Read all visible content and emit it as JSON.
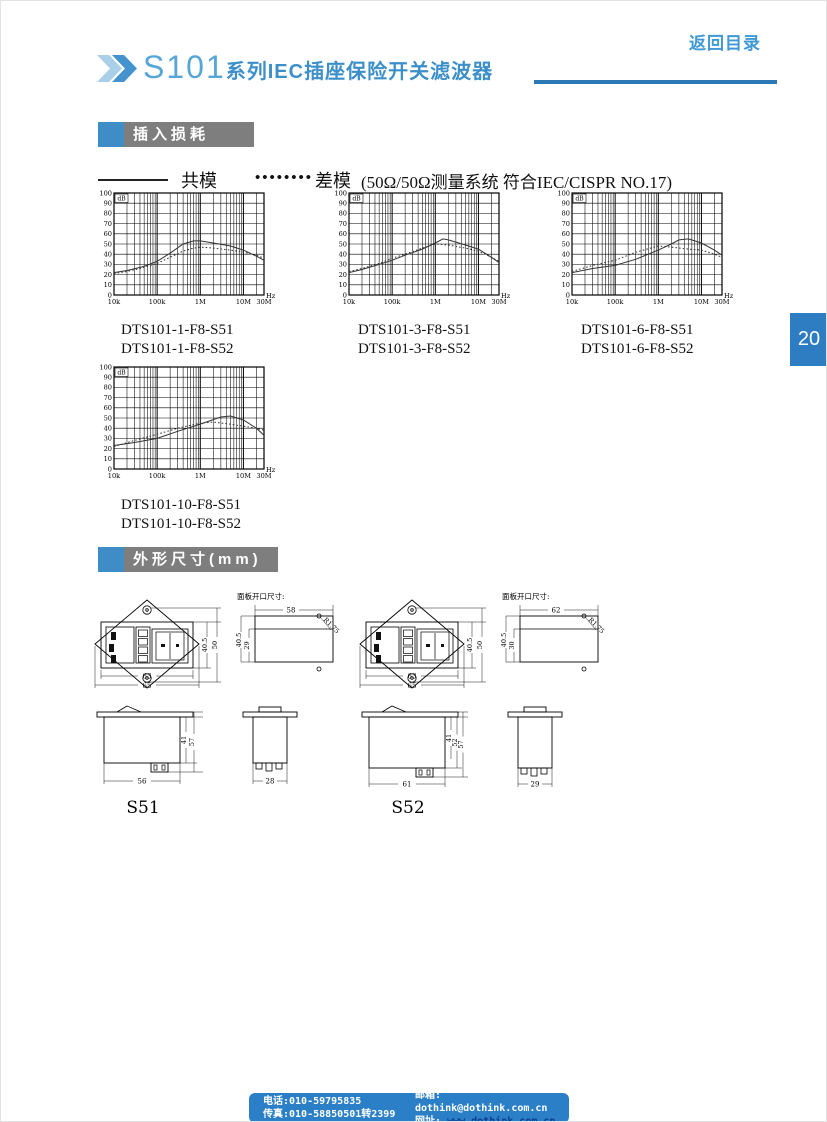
{
  "page": {
    "number": "20"
  },
  "nav": {
    "back_link": "返回目录"
  },
  "header": {
    "series": "S101",
    "title_rest": "系列IEC插座保险开关滤波器"
  },
  "sections": {
    "insertion_loss": "插入损耗",
    "dimensions": "外形尺寸(mm)"
  },
  "legend": {
    "solid_label": "共模",
    "dots": "••••••••",
    "dotted_label": "差模",
    "note": "(50Ω/50Ω测量系统 符合IEC/CISPR NO.17)"
  },
  "chart_data": [
    {
      "type": "line",
      "caption_lines": [
        "DTS101-1-F8-S51",
        "DTS101-1-F8-S52"
      ],
      "xlabel_unit": "Hz",
      "ylabel_unit": "dB",
      "ylim": [
        0,
        100
      ],
      "y_step": 10,
      "x_log_range_hz": [
        10000,
        30000000
      ],
      "x_ticks": [
        {
          "hz": 10000,
          "label": "10k"
        },
        {
          "hz": 100000,
          "label": "100k"
        },
        {
          "hz": 1000000,
          "label": "1M"
        },
        {
          "hz": 10000000,
          "label": "10M"
        },
        {
          "hz": 30000000,
          "label": "30M"
        }
      ],
      "series": [
        {
          "name": "共模",
          "style": "solid",
          "points": [
            [
              10000,
              22
            ],
            [
              20000,
              24
            ],
            [
              50000,
              28
            ],
            [
              100000,
              33
            ],
            [
              200000,
              41
            ],
            [
              400000,
              50
            ],
            [
              700000,
              53
            ],
            [
              1000000,
              53
            ],
            [
              2000000,
              51
            ],
            [
              5000000,
              48
            ],
            [
              10000000,
              44
            ],
            [
              20000000,
              38
            ],
            [
              30000000,
              34
            ]
          ]
        },
        {
          "name": "差模",
          "style": "dotted",
          "points": [
            [
              10000,
              21
            ],
            [
              20000,
              23
            ],
            [
              50000,
              27
            ],
            [
              100000,
              31
            ],
            [
              200000,
              37
            ],
            [
              400000,
              43
            ],
            [
              700000,
              46
            ],
            [
              1000000,
              47
            ],
            [
              2000000,
              46
            ],
            [
              5000000,
              44
            ],
            [
              10000000,
              42
            ],
            [
              20000000,
              39
            ],
            [
              30000000,
              36
            ]
          ]
        }
      ]
    },
    {
      "type": "line",
      "caption_lines": [
        "DTS101-3-F8-S51",
        "DTS101-3-F8-S52"
      ],
      "xlabel_unit": "Hz",
      "ylabel_unit": "dB",
      "ylim": [
        0,
        100
      ],
      "y_step": 10,
      "x_log_range_hz": [
        10000,
        30000000
      ],
      "x_ticks": [
        {
          "hz": 10000,
          "label": "10k"
        },
        {
          "hz": 100000,
          "label": "100k"
        },
        {
          "hz": 1000000,
          "label": "1M"
        },
        {
          "hz": 10000000,
          "label": "10M"
        },
        {
          "hz": 30000000,
          "label": "30M"
        }
      ],
      "series": [
        {
          "name": "共模",
          "style": "solid",
          "points": [
            [
              10000,
              22
            ],
            [
              20000,
              25
            ],
            [
              50000,
              30
            ],
            [
              100000,
              34
            ],
            [
              200000,
              39
            ],
            [
              500000,
              45
            ],
            [
              1000000,
              51
            ],
            [
              1500000,
              55
            ],
            [
              2000000,
              54
            ],
            [
              5000000,
              49
            ],
            [
              10000000,
              45
            ],
            [
              20000000,
              37
            ],
            [
              30000000,
              32
            ]
          ]
        },
        {
          "name": "差模",
          "style": "dotted",
          "points": [
            [
              10000,
              23
            ],
            [
              20000,
              26
            ],
            [
              50000,
              31
            ],
            [
              100000,
              36
            ],
            [
              200000,
              40
            ],
            [
              500000,
              46
            ],
            [
              1000000,
              50
            ],
            [
              2000000,
              49
            ],
            [
              5000000,
              46
            ],
            [
              10000000,
              43
            ],
            [
              20000000,
              37
            ],
            [
              30000000,
              33
            ]
          ]
        }
      ]
    },
    {
      "type": "line",
      "caption_lines": [
        "DTS101-6-F8-S51",
        "DTS101-6-F8-S52"
      ],
      "xlabel_unit": "Hz",
      "ylabel_unit": "dB",
      "ylim": [
        0,
        100
      ],
      "y_step": 10,
      "x_log_range_hz": [
        10000,
        30000000
      ],
      "x_ticks": [
        {
          "hz": 10000,
          "label": "10k"
        },
        {
          "hz": 100000,
          "label": "100k"
        },
        {
          "hz": 1000000,
          "label": "1M"
        },
        {
          "hz": 10000000,
          "label": "10M"
        },
        {
          "hz": 30000000,
          "label": "30M"
        }
      ],
      "series": [
        {
          "name": "共模",
          "style": "solid",
          "points": [
            [
              10000,
              22
            ],
            [
              30000,
              26
            ],
            [
              100000,
              29
            ],
            [
              300000,
              35
            ],
            [
              1000000,
              44
            ],
            [
              2000000,
              50
            ],
            [
              3000000,
              54
            ],
            [
              5000000,
              55
            ],
            [
              10000000,
              51
            ],
            [
              20000000,
              44
            ],
            [
              30000000,
              39
            ]
          ]
        },
        {
          "name": "差模",
          "style": "dotted",
          "points": [
            [
              10000,
              23
            ],
            [
              30000,
              29
            ],
            [
              100000,
              34
            ],
            [
              300000,
              42
            ],
            [
              1000000,
              48
            ],
            [
              2000000,
              47
            ],
            [
              5000000,
              45
            ],
            [
              10000000,
              44
            ],
            [
              20000000,
              40
            ],
            [
              30000000,
              37
            ]
          ]
        }
      ]
    },
    {
      "type": "line",
      "caption_lines": [
        "DTS101-10-F8-S51",
        "DTS101-10-F8-S52"
      ],
      "xlabel_unit": "Hz",
      "ylabel_unit": "dB",
      "ylim": [
        0,
        100
      ],
      "y_step": 10,
      "x_log_range_hz": [
        10000,
        30000000
      ],
      "x_ticks": [
        {
          "hz": 10000,
          "label": "10k"
        },
        {
          "hz": 100000,
          "label": "100k"
        },
        {
          "hz": 1000000,
          "label": "1M"
        },
        {
          "hz": 10000000,
          "label": "10M"
        },
        {
          "hz": 30000000,
          "label": "30M"
        }
      ],
      "series": [
        {
          "name": "共模",
          "style": "solid",
          "points": [
            [
              10000,
              23
            ],
            [
              30000,
              26
            ],
            [
              100000,
              30
            ],
            [
              300000,
              37
            ],
            [
              1000000,
              44
            ],
            [
              3000000,
              51
            ],
            [
              5000000,
              52
            ],
            [
              10000000,
              48
            ],
            [
              20000000,
              40
            ],
            [
              30000000,
              33
            ]
          ]
        },
        {
          "name": "差模",
          "style": "dotted",
          "points": [
            [
              10000,
              22
            ],
            [
              30000,
              28
            ],
            [
              100000,
              34
            ],
            [
              300000,
              40
            ],
            [
              1000000,
              45
            ],
            [
              2000000,
              46
            ],
            [
              5000000,
              44
            ],
            [
              10000000,
              42
            ],
            [
              20000000,
              40
            ],
            [
              30000000,
              38
            ]
          ]
        }
      ]
    }
  ],
  "drawings": {
    "panel_cutout_label": "面板开口尺寸:",
    "s51": {
      "label": "S51",
      "front": {
        "module_width": "63",
        "total_width": "65",
        "module_height": "40.5",
        "total_height": "50"
      },
      "cutout": {
        "width": "58",
        "outer_height": "40.5",
        "inner_height": "29",
        "radius": "R1.75"
      },
      "side": {
        "body_height": "41",
        "total_height": "57",
        "width": "56"
      },
      "profile": {
        "width": "28"
      }
    },
    "s52": {
      "label": "S52",
      "front": {
        "module_width": "63",
        "total_width": "65",
        "module_height": "40.5",
        "total_height": "50"
      },
      "cutout": {
        "width": "62",
        "outer_height": "40.5",
        "inner_height": "30",
        "radius": "R1.75"
      },
      "side": {
        "body_height": "41",
        "mid_height": "52",
        "total_height": "57",
        "width": "61"
      },
      "profile": {
        "width": "29"
      }
    }
  },
  "footer": {
    "phone": "电话:010-59795835",
    "fax": "传真:010-58850501转2399",
    "email_label": "邮箱:",
    "email": "dothink@dothink.com.cn",
    "web_label": "网址:",
    "web": "www.dothink.com.cn"
  },
  "colors": {
    "brand_blue": "#3c8fc9",
    "light_blue": "#a9cfe9",
    "bar_gray": "#7e7e7e",
    "tab_blue": "#2e7dc3",
    "footer_blue": "#2a7fc7",
    "link_navy": "#0b3b8c"
  }
}
